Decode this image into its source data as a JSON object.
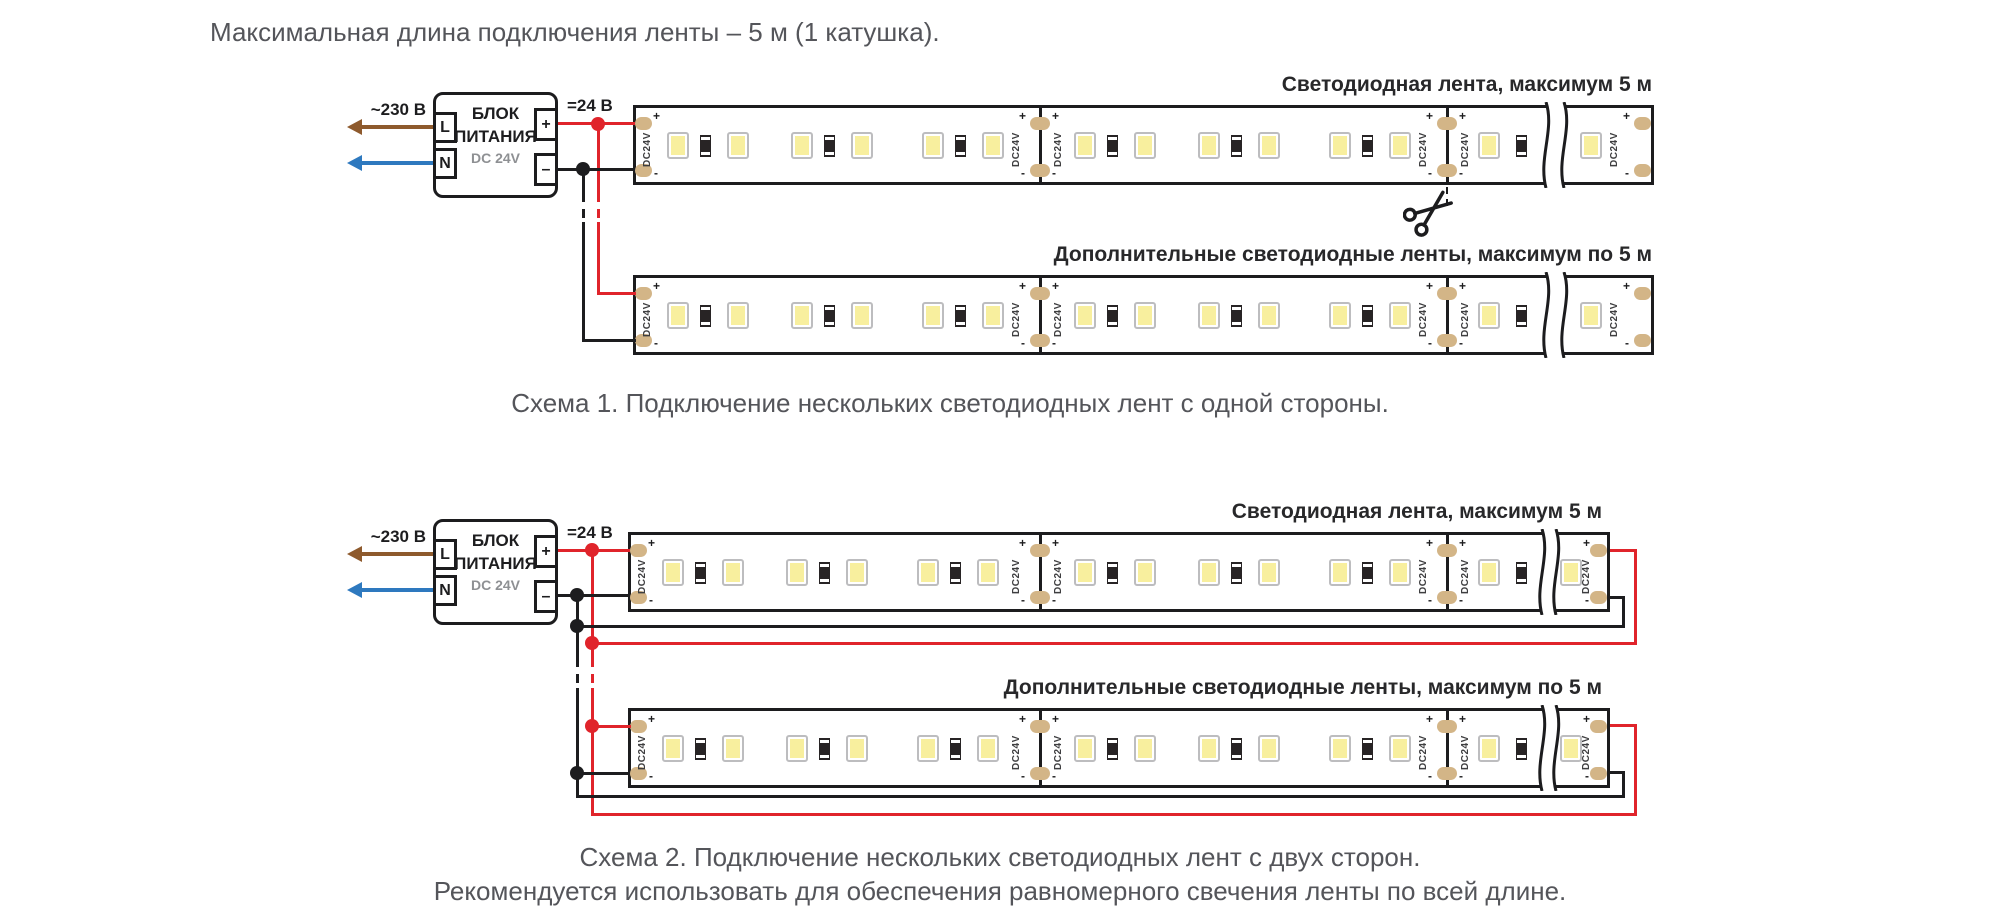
{
  "title": "Максимальная длина подключения ленты – 5 м (1 катушка).",
  "psu": {
    "name_line1": "БЛОК",
    "name_line2": "ПИТАНИЯ",
    "dc_label": "DC 24V",
    "terminal_l": "L",
    "terminal_n": "N",
    "terminal_plus": "+",
    "terminal_minus": "–",
    "input_label": "~230 В",
    "output_label": "=24 В"
  },
  "strip": {
    "voltage": "DC24V",
    "plus": "+",
    "minus": "-"
  },
  "schema1": {
    "strip1_label": "Светодиодная лента, максимум 5 м",
    "strip2_label": "Дополнительные светодиодные ленты, максимум по 5 м",
    "caption": "Схема 1. Подключение нескольких светодиодных лент с одной стороны."
  },
  "schema2": {
    "strip1_label": "Светодиодная лента, максимум 5 м",
    "strip2_label": "Дополнительные светодиодные ленты, максимум по 5 м",
    "caption": "Схема 2. Подключение нескольких светодиодных лент с двух сторон.",
    "note": "Рекомендуется использовать для обеспечения равномерного свечения ленты по всей длине."
  },
  "colors": {
    "wire_positive": "#e0242b",
    "wire_negative": "#1d1d1f",
    "arrow_live": "#8e5a2d",
    "arrow_neutral": "#2e79bf",
    "solder_pad": "#d3b587",
    "led_fill": "#f8ef9e"
  }
}
